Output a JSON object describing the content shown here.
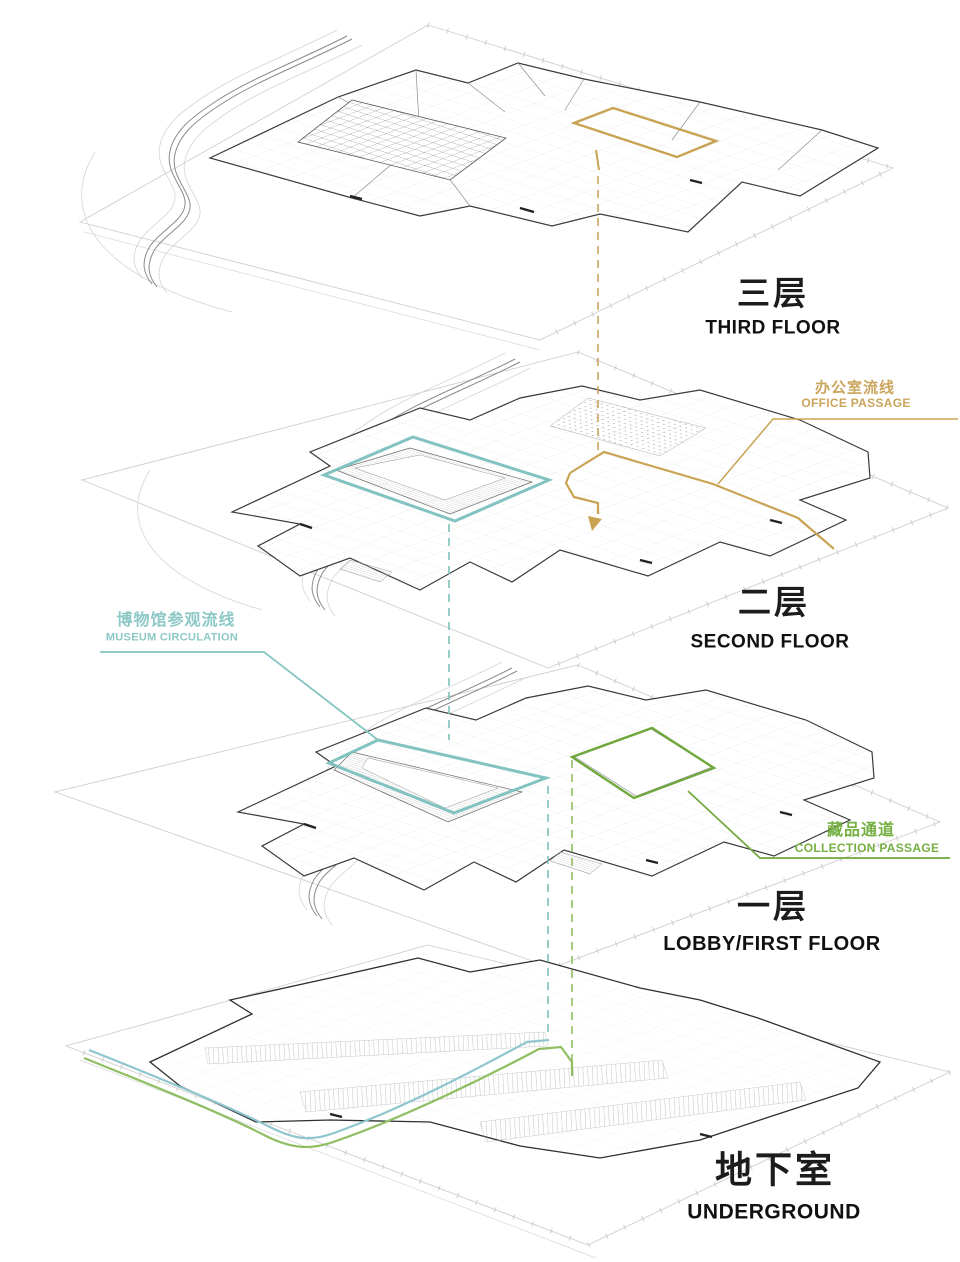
{
  "floors": [
    {
      "name_zh": "三层",
      "name_en": "THIRD FLOOR"
    },
    {
      "name_zh": "二层",
      "name_en": "SECOND FLOOR"
    },
    {
      "name_zh": "一层",
      "name_en": "LOBBY/FIRST FLOOR"
    },
    {
      "name_zh": "地下室",
      "name_en": "UNDERGROUND"
    }
  ],
  "legends": [
    {
      "name_zh": "办公室流线",
      "name_en": "OFFICE PASSAGE",
      "color": "#C9A353"
    },
    {
      "name_zh": "博物馆参观流线",
      "name_en": "MUSEUM CIRCULATION",
      "color": "#8CC8C6"
    },
    {
      "name_zh": "藏品通道",
      "name_en": "COLLECTION PASSAGE",
      "color": "#76B043"
    }
  ],
  "colors": {
    "office_route": "#C9A353",
    "museum_route": "#7BBFBD",
    "collection_route": "#6FA83C",
    "museum_route_underground": "#8FC6CD",
    "collection_route_underground": "#8FBE62",
    "plan_dark": "#3A3A3A",
    "plan_light": "#A5A5A5",
    "site_line": "#CFCFCF"
  }
}
